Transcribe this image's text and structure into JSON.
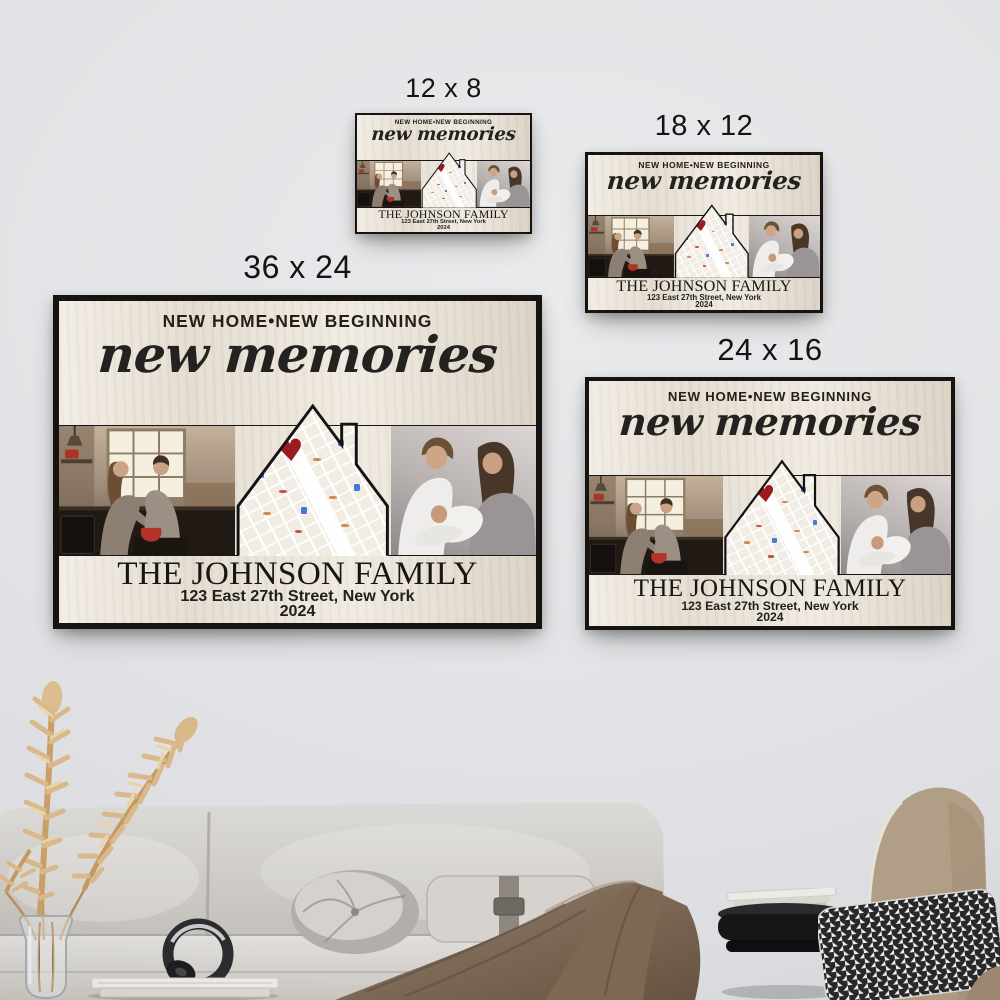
{
  "posters": [
    {
      "id": "12x8",
      "size_label": "12 x 8"
    },
    {
      "id": "18x12",
      "size_label": "18 x 12"
    },
    {
      "id": "36x24",
      "size_label": "36 x 24"
    },
    {
      "id": "24x16",
      "size_label": "24 x 16"
    }
  ],
  "artwork": {
    "tagline": "NEW HOME•NEW BEGINNING",
    "title_script": "new memories",
    "family_name": "THE JOHNSON FAMILY",
    "address": "123 East 27th Street, New York",
    "year": "2024",
    "heart_glyph": "♥",
    "icons": {
      "map_marker": "heart-icon",
      "map_poi": "transit-icon"
    },
    "colors": {
      "canvas_background": "#ece5d9",
      "frame": "#161310",
      "heart": "#9c1b1f",
      "text": "#1c1a18",
      "wall": "#e2e3e6"
    }
  }
}
